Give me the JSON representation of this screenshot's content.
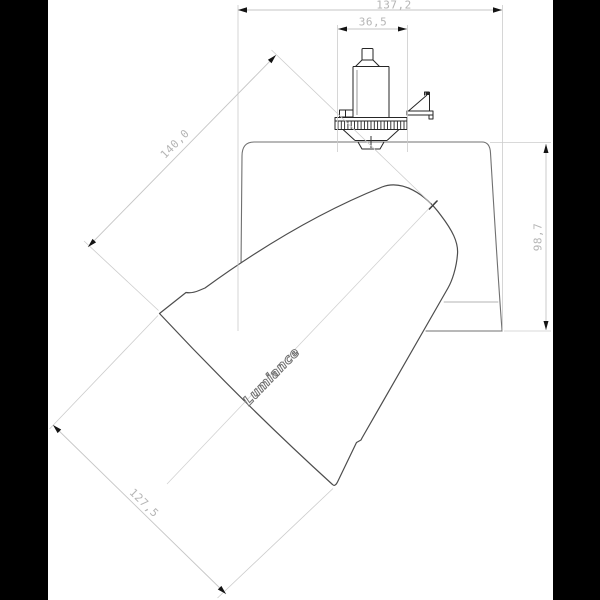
{
  "drawing": {
    "title": "Track spotlight dimension drawing",
    "brand_label": "Lumiance",
    "dimensions": {
      "overall_width_mm": "137,2",
      "adapter_width_mm": "36,5",
      "head_length_mm": "140,0",
      "head_diameter_mm": "127,5",
      "body_height_mm": "98,7"
    },
    "colors": {
      "background": "#ffffff",
      "letterbox": "#000000",
      "housing_line": "#707070",
      "head_line": "#4d4d4d",
      "adapter_line": "#262626",
      "dimension_line": "#c6c6c6",
      "dimension_text": "#b5b5b5",
      "arrow": "#141414"
    }
  }
}
